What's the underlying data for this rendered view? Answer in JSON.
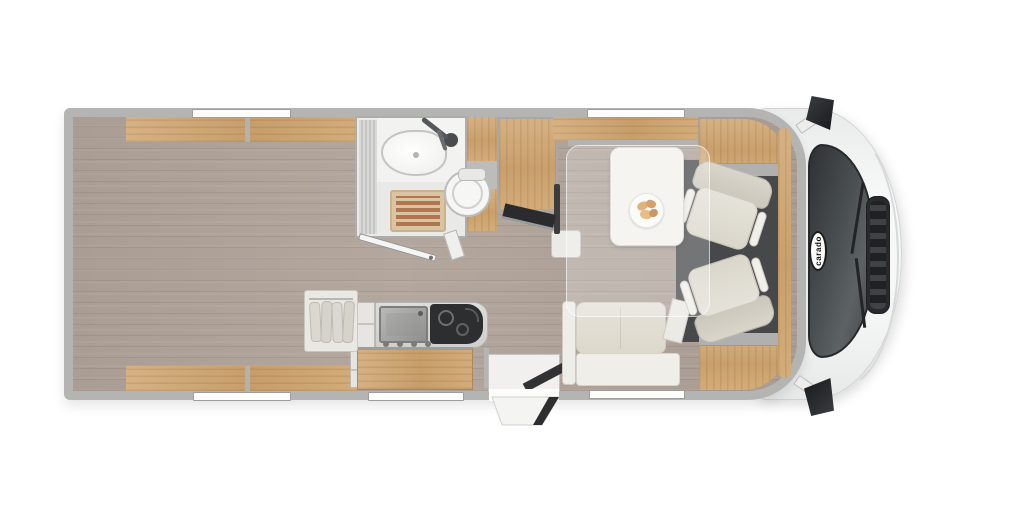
{
  "title": "motorhome-floor-plan-top-view",
  "brand": {
    "badge_text": "carado"
  },
  "palette": {
    "background": "#ffffff",
    "wall_gray": "#b4b4b2",
    "wood_light": "#d6b183",
    "wood_dark": "#c9a06c",
    "floor_planks": "#a99d94",
    "floor_dark_patch": "#8b7f76",
    "upholstery_cream": "#e0dcd2",
    "white_furniture": "#efeee9",
    "cab_floor": "#47484a",
    "glass_dark": "#35383a",
    "shower_mat_terracotta": "#b1764f",
    "cab_body": "#f5f6f6"
  },
  "rooms": {
    "rear_bedroom": {
      "features": [
        "twin-single-bed-top",
        "twin-single-bed-bottom",
        "pillows",
        "center-cushion",
        "entry-steps",
        "wardrobe-with-hangers",
        "overhead-shelves",
        "rear-wood-deck"
      ]
    },
    "bathroom": {
      "features": [
        "corner-washbasin",
        "faucet",
        "round-toilet",
        "teak-shower-mat",
        "open-door"
      ]
    },
    "kitchen": {
      "features": [
        "stainless-sink",
        "two-burner-hob",
        "wood-drawer-front",
        "shelf-unit",
        "control-knobs"
      ]
    },
    "dinette": {
      "features": [
        "table",
        "breakfast-plate",
        "bench-seat",
        "tv-on-swivel-bracket",
        "drop-down-bed-outline",
        "overhead-shelf"
      ]
    },
    "cab": {
      "features": [
        "driver-swivel-seat",
        "passenger-swivel-seat",
        "dark-cab-floor",
        "windshield",
        "front-grille",
        "wipers",
        "side-mirror-top",
        "side-mirror-bottom",
        "brand-badge",
        "overhead-lockers"
      ]
    },
    "entrance": {
      "features": [
        "door-opening",
        "interior-step-wedge",
        "exterior-step"
      ]
    },
    "windows": {
      "count": 5
    }
  }
}
